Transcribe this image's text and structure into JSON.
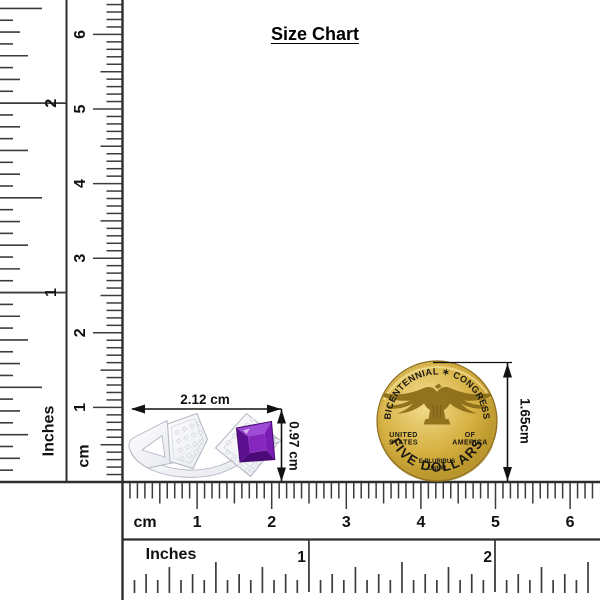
{
  "title": "Size Chart",
  "colors": {
    "frame_line": "#2e2e2e",
    "tick": "#3c3c3c",
    "number": "#111111",
    "dim_line": "#111111",
    "gold_light": "#f2dd90",
    "gold_mid": "#d6b041",
    "gold_dark": "#aa871f",
    "gold_rim": "#8c6c1c",
    "gold_text": "#7a5f18",
    "gold_relief": "#8a6b17",
    "metal_light": "#ffffff",
    "metal_dark": "#e6e8ee",
    "metal_stroke": "#b2b6c2",
    "metal_inner_line": "#d4d7de",
    "sparkle_fill": "#f7f8fb",
    "sparkle_stroke": "#c3c7d2",
    "amethyst_top": "#9d4bd6",
    "amethyst_right": "#7a1cb4",
    "amethyst_bottom": "#4b0a77",
    "amethyst_left": "#5c0f8e",
    "amethyst_table": "#8527bd",
    "amethyst_edge": "#45096e"
  },
  "ring": {
    "width_label": "2.12 cm",
    "height_label": "0.97 cm"
  },
  "coin": {
    "diameter_label": "1.65cm",
    "arc_top": "BICENTENNIAL ✶ CONGRESS",
    "arc_bottom": "FIVE DOLLARS",
    "left_top": "UNITED",
    "left_bottom": "STATES",
    "right_top": "OF",
    "right_bottom": "AMERICA",
    "motto_top": "E PLURIBUS",
    "motto_bottom": "UNUM"
  },
  "rulers": {
    "left_inches": {
      "label": "Inches",
      "numbers": [
        {
          "label": "1",
          "unit": 1
        },
        {
          "label": "2",
          "unit": 2
        }
      ]
    },
    "left_cm": {
      "label": "cm",
      "numbers": [
        {
          "label": "1",
          "unit": 1
        },
        {
          "label": "2",
          "unit": 2
        },
        {
          "label": "3",
          "unit": 3
        },
        {
          "label": "4",
          "unit": 4
        },
        {
          "label": "5",
          "unit": 5
        },
        {
          "label": "6",
          "unit": 6
        }
      ]
    },
    "bottom_cm": {
      "label": "cm",
      "numbers": [
        {
          "label": "1",
          "unit": 1
        },
        {
          "label": "2",
          "unit": 2
        },
        {
          "label": "3",
          "unit": 3
        },
        {
          "label": "4",
          "unit": 4
        },
        {
          "label": "5",
          "unit": 5
        },
        {
          "label": "6",
          "unit": 6
        }
      ]
    },
    "bottom_inches": {
      "label": "Inches",
      "numbers": [
        {
          "label": "1",
          "unit": 1
        },
        {
          "label": "2",
          "unit": 2
        }
      ]
    }
  }
}
